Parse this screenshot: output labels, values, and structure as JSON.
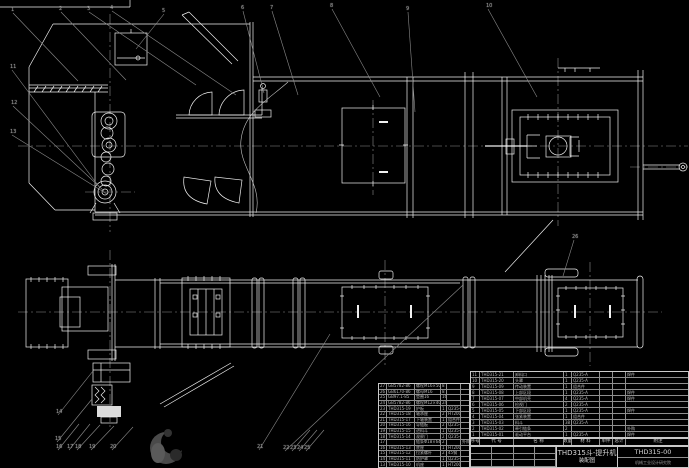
{
  "page": {
    "background_color": "#000000",
    "line_color": "#f0f0f0",
    "leader_color": "#8a8a8a"
  },
  "title_block": {
    "product": "THD315斗-提升机",
    "doc_type": "装配图",
    "drawing_number": "THD315-00",
    "company": "机械工业设计研究院"
  },
  "bom_header": {
    "columns": [
      "序号",
      "代  号",
      "名  称",
      "数量",
      "材  料",
      "单件",
      "总计",
      "附注"
    ]
  },
  "bom_right": {
    "rows": [
      [
        "11",
        "THD315-21",
        "卸料口",
        "1",
        "Q235-A",
        "",
        "",
        "焊件"
      ],
      [
        "10",
        "THD315-20",
        "头罩",
        "1",
        "Q235-A",
        "",
        "",
        ""
      ],
      [
        "9",
        "THD315-09",
        "传动装置",
        "1",
        "组合件",
        "",
        "",
        ""
      ],
      [
        "8",
        "THD315-08",
        "上部区段",
        "1",
        "Q235-A",
        "",
        "",
        "焊件"
      ],
      [
        "7",
        "THD315-07",
        "中部机壳",
        "4",
        "Q235-A",
        "",
        "",
        "焊件"
      ],
      [
        "6",
        "THD315-06",
        "检视门",
        "2",
        "Q235-A",
        "",
        "",
        ""
      ],
      [
        "5",
        "THD315-05",
        "下部区段",
        "1",
        "Q235-A",
        "",
        "",
        "焊件"
      ],
      [
        "4",
        "THD315-04",
        "张紧装置",
        "1",
        "组合件",
        "",
        "",
        ""
      ],
      [
        "3",
        "THD315-03",
        "料斗",
        "38",
        "Q235-A",
        "",
        "",
        ""
      ],
      [
        "2",
        "THD315-02",
        "牵引链条",
        "2",
        "",
        "",
        "",
        "外购"
      ],
      [
        "1",
        "THD315-01",
        "驱动平台",
        "1",
        "Q235-A",
        "",
        "",
        "焊件"
      ]
    ]
  },
  "bom_left": {
    "rows": [
      [
        "27",
        "GB5782-86",
        "螺栓M16×50",
        "8",
        "",
        ""
      ],
      [
        "26",
        "GB6170-86",
        "螺母M16",
        "8",
        "",
        ""
      ],
      [
        "25",
        "GB97.1-85",
        "垫圈16",
        "16",
        "",
        ""
      ],
      [
        "24",
        "GB5782-86",
        "螺栓M12×40",
        "24",
        "",
        ""
      ],
      [
        "23",
        "THD315-19",
        "护板",
        "1",
        "Q235-A",
        ""
      ],
      [
        "22",
        "THD315-18",
        "轴承座",
        "2",
        "HT200",
        ""
      ],
      [
        "21",
        "THD315-17",
        "下轴装置",
        "1",
        "组合件",
        ""
      ],
      [
        "20",
        "THD315-16",
        "导链板",
        "2",
        "Q235-A",
        ""
      ],
      [
        "19",
        "THD315-15",
        "进料斗",
        "1",
        "Q235-A",
        ""
      ],
      [
        "18",
        "THD315-14",
        "观察门",
        "2",
        "Q235-A",
        ""
      ],
      [
        "17",
        "",
        "链条Φ18×64",
        "2",
        "",
        "外购"
      ],
      [
        "16",
        "THD315-13",
        "底座",
        "1",
        "HT200",
        ""
      ],
      [
        "15",
        "THD315-12",
        "拉紧螺杆",
        "2",
        "45钢",
        ""
      ],
      [
        "14",
        "THD315-11",
        "防护罩",
        "1",
        "Q235-A",
        ""
      ],
      [
        "13",
        "THD315-10",
        "机座",
        "1",
        "HT200",
        ""
      ]
    ]
  },
  "callouts": [
    {
      "n": "1",
      "x": 11,
      "y": 8,
      "tx": 78,
      "ty": 81
    },
    {
      "n": "2",
      "x": 59,
      "y": 7,
      "tx": 126,
      "ty": 80
    },
    {
      "n": "3",
      "x": 87,
      "y": 7,
      "tx": 196,
      "ty": 85
    },
    {
      "n": "4",
      "x": 110,
      "y": 6,
      "tx": 236,
      "ty": 95
    },
    {
      "n": "5",
      "x": 162,
      "y": 9,
      "tx": 136,
      "ty": 49
    },
    {
      "n": "6",
      "x": 241,
      "y": 6,
      "tx": 264,
      "ty": 93
    },
    {
      "n": "7",
      "x": 270,
      "y": 6,
      "tx": 298,
      "ty": 95
    },
    {
      "n": "8",
      "x": 330,
      "y": 4,
      "tx": 380,
      "ty": 97
    },
    {
      "n": "9",
      "x": 406,
      "y": 7,
      "tx": 415,
      "ty": 112
    },
    {
      "n": "10",
      "x": 486,
      "y": 4,
      "tx": 537,
      "ty": 97
    },
    {
      "n": "11",
      "x": 10,
      "y": 65,
      "tx": 100,
      "ty": 188
    },
    {
      "n": "12",
      "x": 11,
      "y": 101,
      "tx": 104,
      "ty": 191
    },
    {
      "n": "13",
      "x": 10,
      "y": 130,
      "tx": 107,
      "ty": 194
    },
    {
      "n": "14",
      "x": 56,
      "y": 410,
      "tx": 93,
      "ty": 371
    },
    {
      "n": "15",
      "x": 55,
      "y": 437,
      "tx": 92,
      "ty": 399
    },
    {
      "n": "16",
      "x": 56,
      "y": 445,
      "tx": 79,
      "ty": 424
    },
    {
      "n": "17",
      "x": 67,
      "y": 445,
      "tx": 90,
      "ty": 424
    },
    {
      "n": "18",
      "x": 75,
      "y": 445,
      "tx": 100,
      "ty": 425
    },
    {
      "n": "19",
      "x": 89,
      "y": 445,
      "tx": 114,
      "ty": 426
    },
    {
      "n": "20",
      "x": 110,
      "y": 445,
      "tx": 133,
      "ty": 427
    },
    {
      "n": "21",
      "x": 257,
      "y": 445,
      "tx": 330,
      "ty": 334
    },
    {
      "n": "22",
      "x": 283,
      "y": 446,
      "tx": 463,
      "ty": 285
    },
    {
      "n": "23",
      "x": 290,
      "y": 446,
      "tx": 310,
      "ty": 430
    },
    {
      "n": "24",
      "x": 297,
      "y": 446,
      "tx": 317,
      "ty": 430
    },
    {
      "n": "25",
      "x": 304,
      "y": 446,
      "tx": 324,
      "ty": 430
    },
    {
      "n": "26",
      "x": 572,
      "y": 235,
      "tx": 563,
      "ty": 276
    }
  ]
}
